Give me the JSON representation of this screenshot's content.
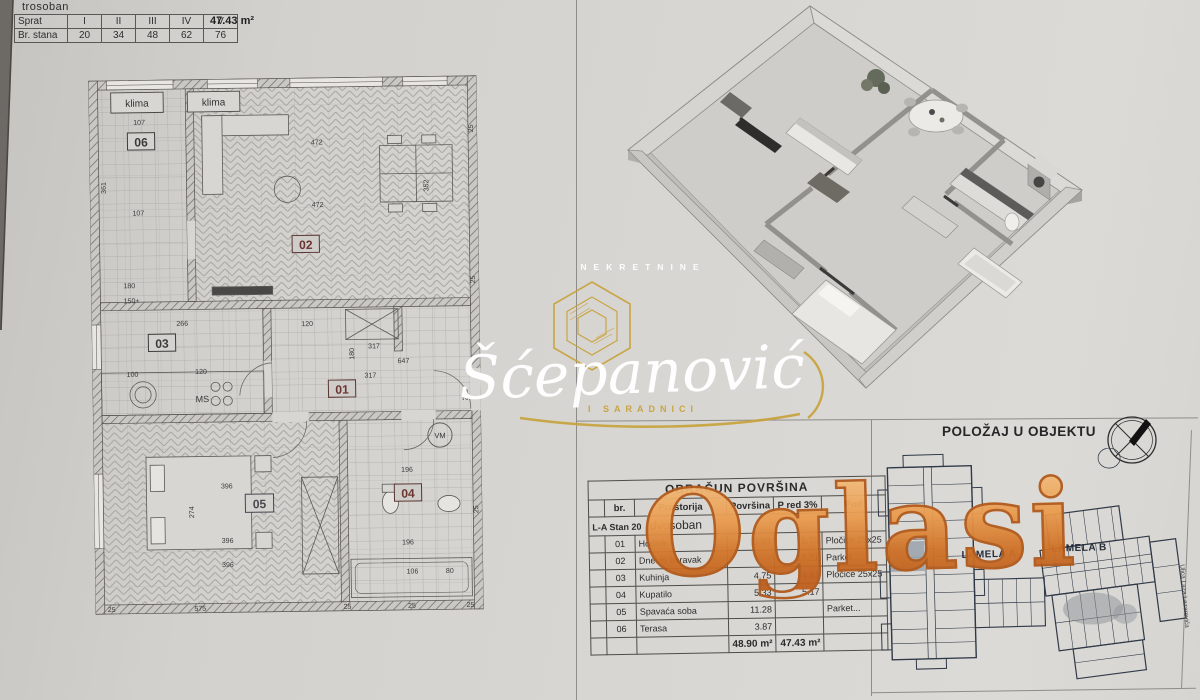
{
  "unit_info": {
    "type_label": "trosoban",
    "row1_header": "Sprat",
    "floors": [
      "I",
      "II",
      "III",
      "IV",
      "V"
    ],
    "row2_header": "Br. stana",
    "unit_numbers": [
      "20",
      "34",
      "48",
      "62",
      "76"
    ],
    "area_label": "47.43 m²"
  },
  "floor_plan": {
    "room_numbers": {
      "r01": "01",
      "r02": "02",
      "r03": "03",
      "r04": "04",
      "r05": "05",
      "r06": "06"
    },
    "labels": {
      "klima": "klima",
      "ms": "MS",
      "vm": "VM"
    },
    "dims": [
      "107",
      "472",
      "107",
      "472",
      "352",
      "361",
      "266",
      "120",
      "317",
      "317",
      "647",
      "180",
      "396",
      "274",
      "396",
      "396",
      "575",
      "25",
      "25",
      "25",
      "196",
      "196",
      "106",
      "80",
      "210",
      "180",
      "150+",
      "25",
      "120",
      "100",
      "25",
      "25",
      "25"
    ]
  },
  "watermarks": {
    "agency_top": "NEKRETNINE",
    "agency_name": "Šćepanović",
    "agency_sub": "I SARADNICI",
    "portal": "Oglasi"
  },
  "area_table": {
    "title": "OBRAČUN POVRŠINA",
    "columns": [
      "br.",
      "Prostorija",
      "Površina",
      "P red 3%",
      "Pod"
    ],
    "unit_line_prefix": "L-A Stan 20",
    "unit_line_type": "dvosoban",
    "rows": [
      {
        "br": "01",
        "room": "Hodnik",
        "area": "5.93",
        "pred": "5.75",
        "floor": "Pločice 25x25"
      },
      {
        "br": "02",
        "room": "Dnevni boravak",
        "area": "",
        "pred": "17.21",
        "floor": "Parket..."
      },
      {
        "br": "03",
        "room": "Kuhinja",
        "area": "4.75",
        "pred": "4.61",
        "floor": "Pločice 25x25"
      },
      {
        "br": "04",
        "room": "Kupatilo",
        "area": "5.33",
        "pred": "5.17",
        "floor": ""
      },
      {
        "br": "05",
        "room": "Spavaća soba",
        "area": "11.28",
        "pred": "",
        "floor": "Parket..."
      },
      {
        "br": "06",
        "room": "Terasa",
        "area": "3.87",
        "pred": "",
        "floor": ""
      }
    ],
    "total_area": "48.90 m²",
    "total_pred": "47.43 m²"
  },
  "position": {
    "title": "POLOŽAJ U OBJEKTU",
    "lamela_a": "LAMELA A",
    "lamela_b": "LAMELA B",
    "street": "Ulica Laza Lazarevića"
  }
}
